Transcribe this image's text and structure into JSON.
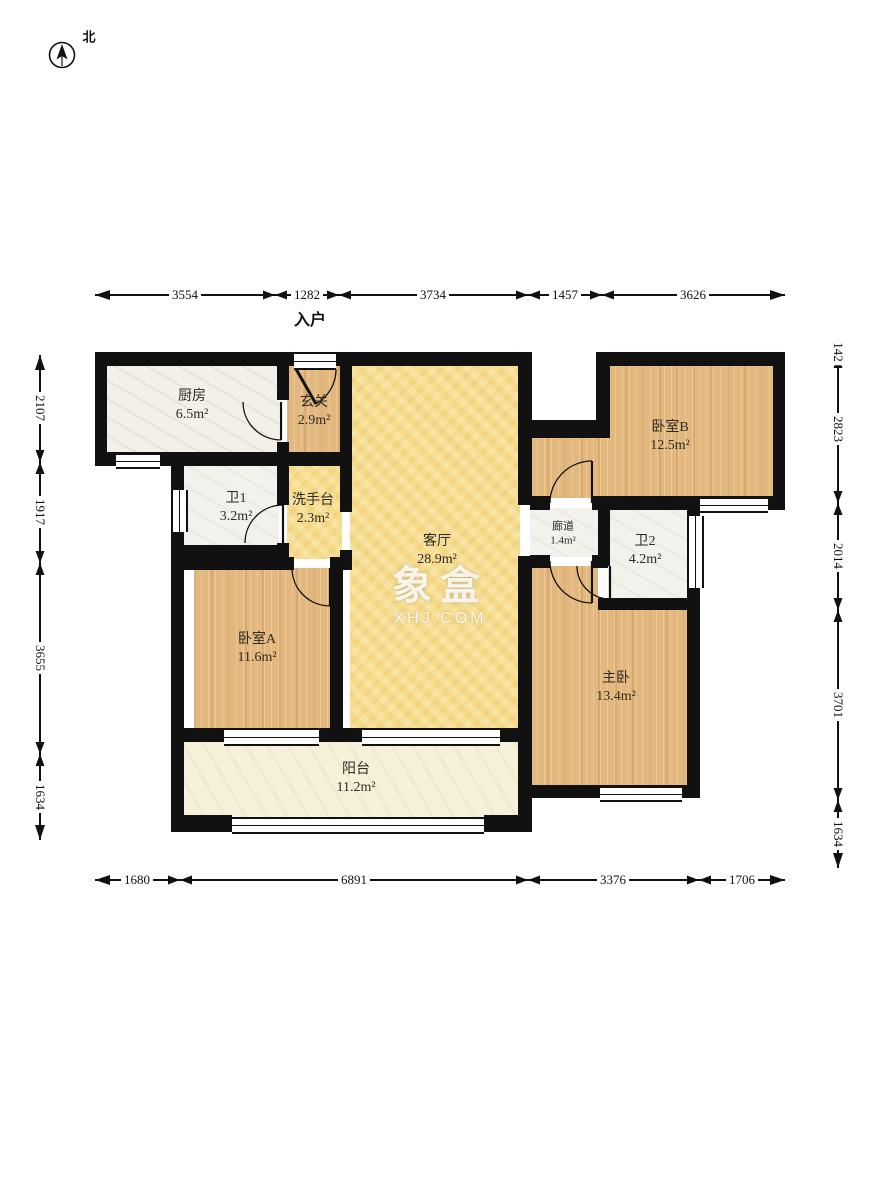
{
  "compass": {
    "north_label": "北"
  },
  "entrance_label": "入户",
  "watermark": {
    "title": "象盒",
    "subtitle": "XHJ.COM"
  },
  "rooms": [
    {
      "id": "kitchen",
      "name": "厨房",
      "area": "6.5m²"
    },
    {
      "id": "hallway",
      "name": "玄关",
      "area": "2.9m²"
    },
    {
      "id": "living",
      "name": "客厅",
      "area": "28.9m²"
    },
    {
      "id": "bedroomB",
      "name": "卧室B",
      "area": "12.5m²"
    },
    {
      "id": "corridor",
      "name": "廊道",
      "area": "1.4m²"
    },
    {
      "id": "bath2",
      "name": "卫2",
      "area": "4.2m²"
    },
    {
      "id": "master",
      "name": "主卧",
      "area": "13.4m²"
    },
    {
      "id": "bath1",
      "name": "卫1",
      "area": "3.2m²"
    },
    {
      "id": "washstand",
      "name": "洗手台",
      "area": "2.3m²"
    },
    {
      "id": "bedroomA",
      "name": "卧室A",
      "area": "11.6m²"
    },
    {
      "id": "balcony",
      "name": "阳台",
      "area": "11.2m²"
    }
  ],
  "dimensions": {
    "top": [
      "3554",
      "1282",
      "3734",
      "1457",
      "3626"
    ],
    "bottom": [
      "1680",
      "6891",
      "3376",
      "1706"
    ],
    "left": [
      "2107",
      "1917",
      "3655",
      "1634"
    ],
    "right": [
      "142",
      "2823",
      "2014",
      "3701",
      "1634"
    ]
  },
  "colors": {
    "wall": "#111111",
    "wood_floor": "#e3b87e",
    "living_floor": "#f6db8b",
    "tile_floor": "#f2f0e9",
    "balcony_floor": "#f7f0da",
    "watermark": "#ffffff"
  }
}
